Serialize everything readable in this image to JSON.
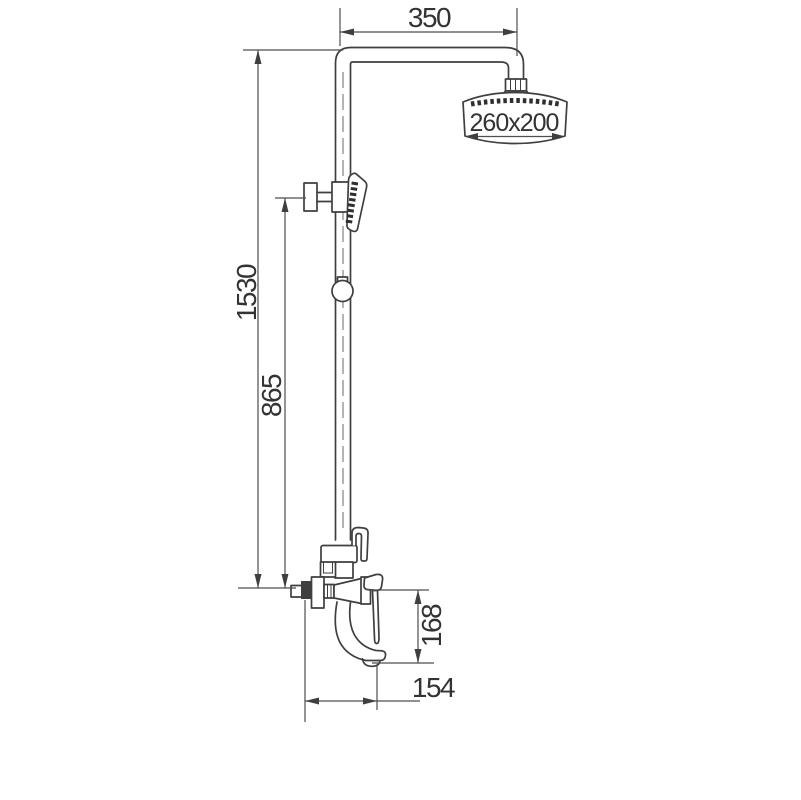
{
  "drawing": {
    "kind": "technical-line-drawing",
    "subject": "exposed shower column with rain head, hand shower and spout mixer"
  },
  "dimensions": {
    "arm_width": "350",
    "head_size": "260x200",
    "overall_height": "1530",
    "riser_height": "865",
    "spout_height": "168",
    "spout_reach": "154"
  },
  "colors": {
    "line": "#3f3f3f",
    "dimension_line": "#4e4e4e",
    "text": "#333333",
    "background": "#ffffff"
  }
}
